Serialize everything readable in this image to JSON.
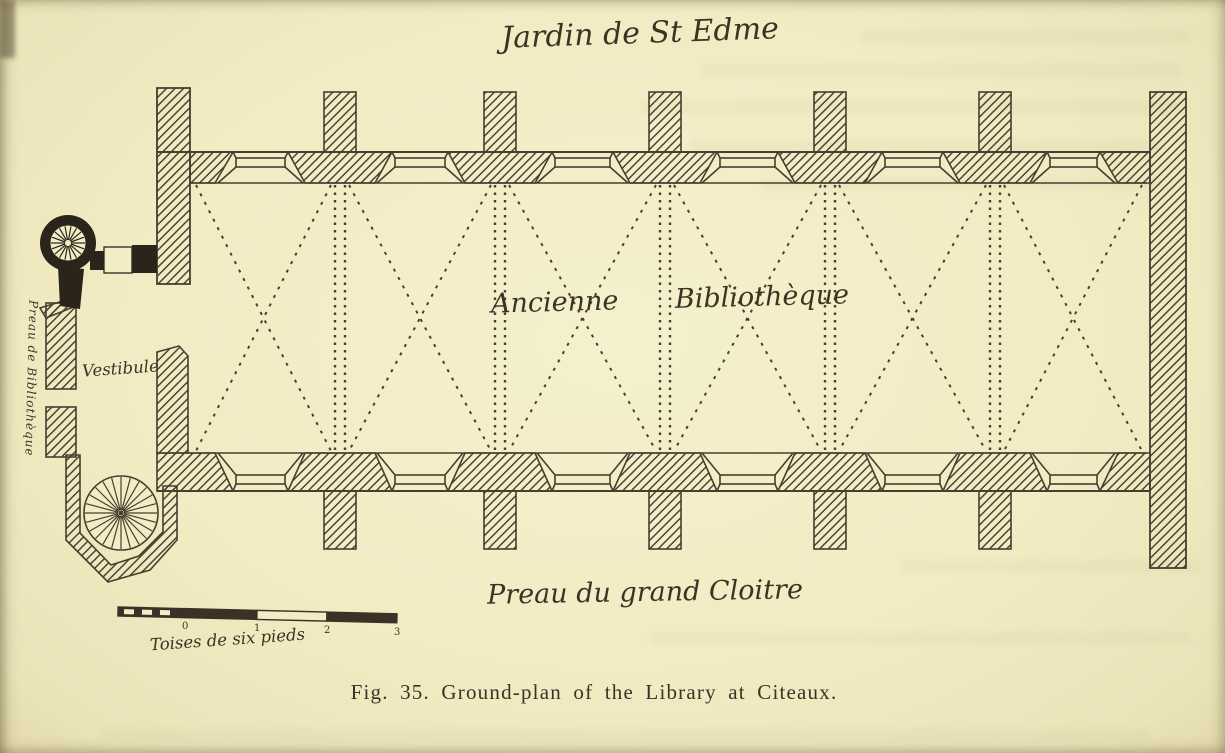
{
  "page": {
    "paper_color": "#f3edc6",
    "ink_color": "#433a2b"
  },
  "figure": {
    "caption": "Fig. 35. Ground-plan of the Library at Citeaux.",
    "plan_labels": {
      "garden": "Jardin de St Edme",
      "hall": "Ancienne Bibliothèque",
      "cloister": "Preau du grand Cloitre",
      "vestibule": "Vestibule",
      "west_passage": "Preau de Bibliothèque"
    },
    "scale_bar": {
      "unit_label": "Toises de six pieds",
      "ticks": [
        "0",
        "1",
        "2",
        "3"
      ]
    }
  }
}
